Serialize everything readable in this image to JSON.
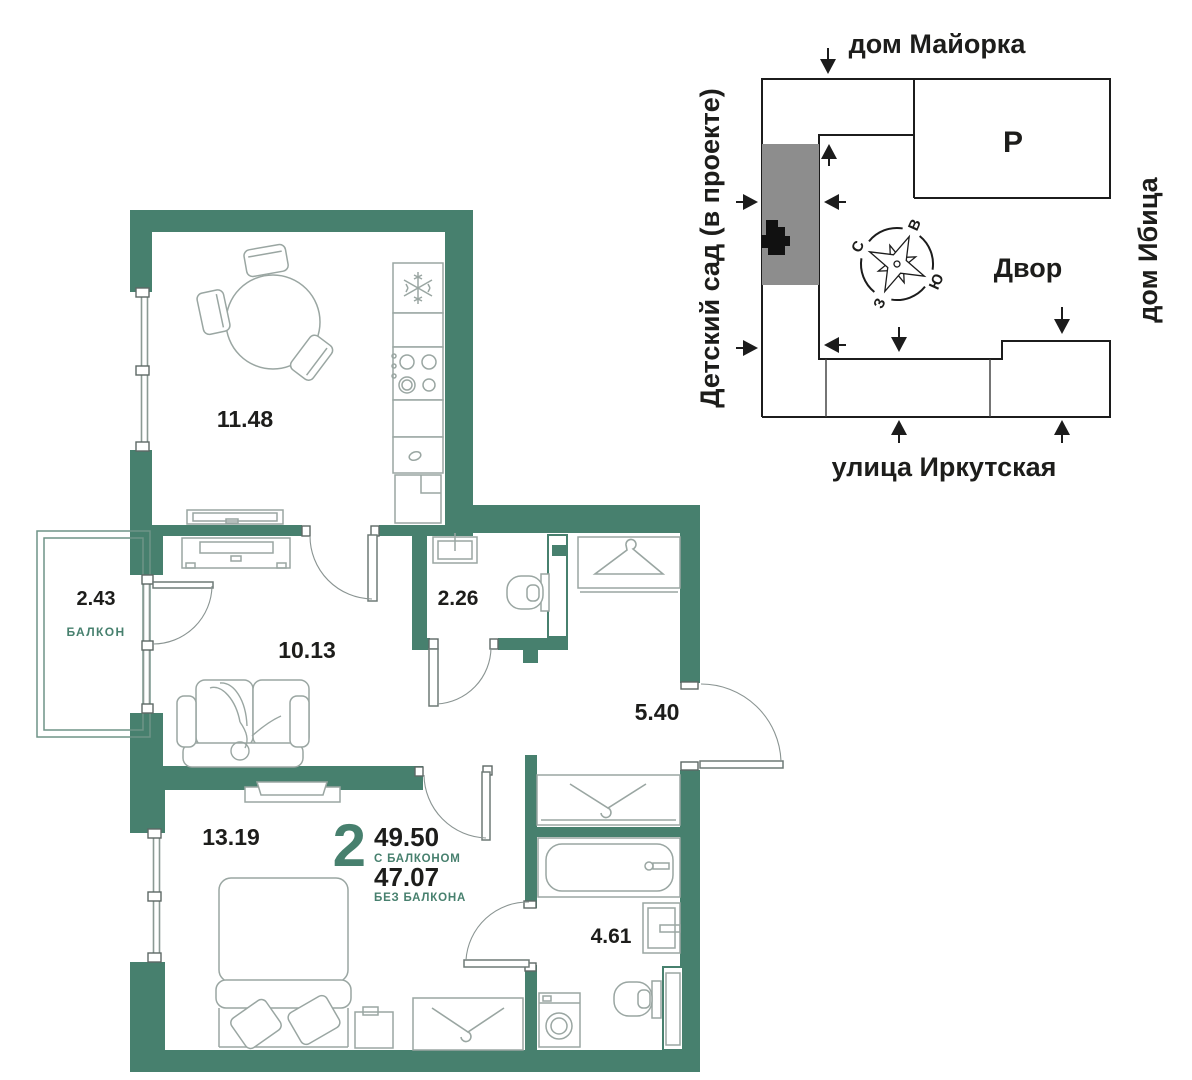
{
  "apartment": {
    "rooms_count": "2",
    "area_with_balcony": "49.50",
    "with_balcony_label": "С БАЛКОНОМ",
    "area_without_balcony": "47.07",
    "without_balcony_label": "БЕЗ БАЛКОНА"
  },
  "rooms": {
    "kitchen_area": "11.48",
    "balcony_area": "2.43",
    "balcony_label": "БАЛКОН",
    "living_area": "10.13",
    "wc_area": "2.26",
    "hallway_area": "5.40",
    "bedroom_area": "13.19",
    "bathroom_area": "4.61"
  },
  "site_plan": {
    "house_top": "дом Майорка",
    "house_right": "дом Ибица",
    "kindergarten": "Детский сад (в проекте)",
    "street": "улица Иркутская",
    "parking_label": "Р",
    "courtyard_label": "Двор",
    "compass": {
      "north": "С",
      "east": "В",
      "south": "Ю",
      "west": "З"
    }
  },
  "colors": {
    "wall": "#47806E",
    "accent_text": "#47806E",
    "furniture_line": "#9AA6A2",
    "site_line": "#1C1C1C",
    "building_gray": "#8D8D8D"
  }
}
